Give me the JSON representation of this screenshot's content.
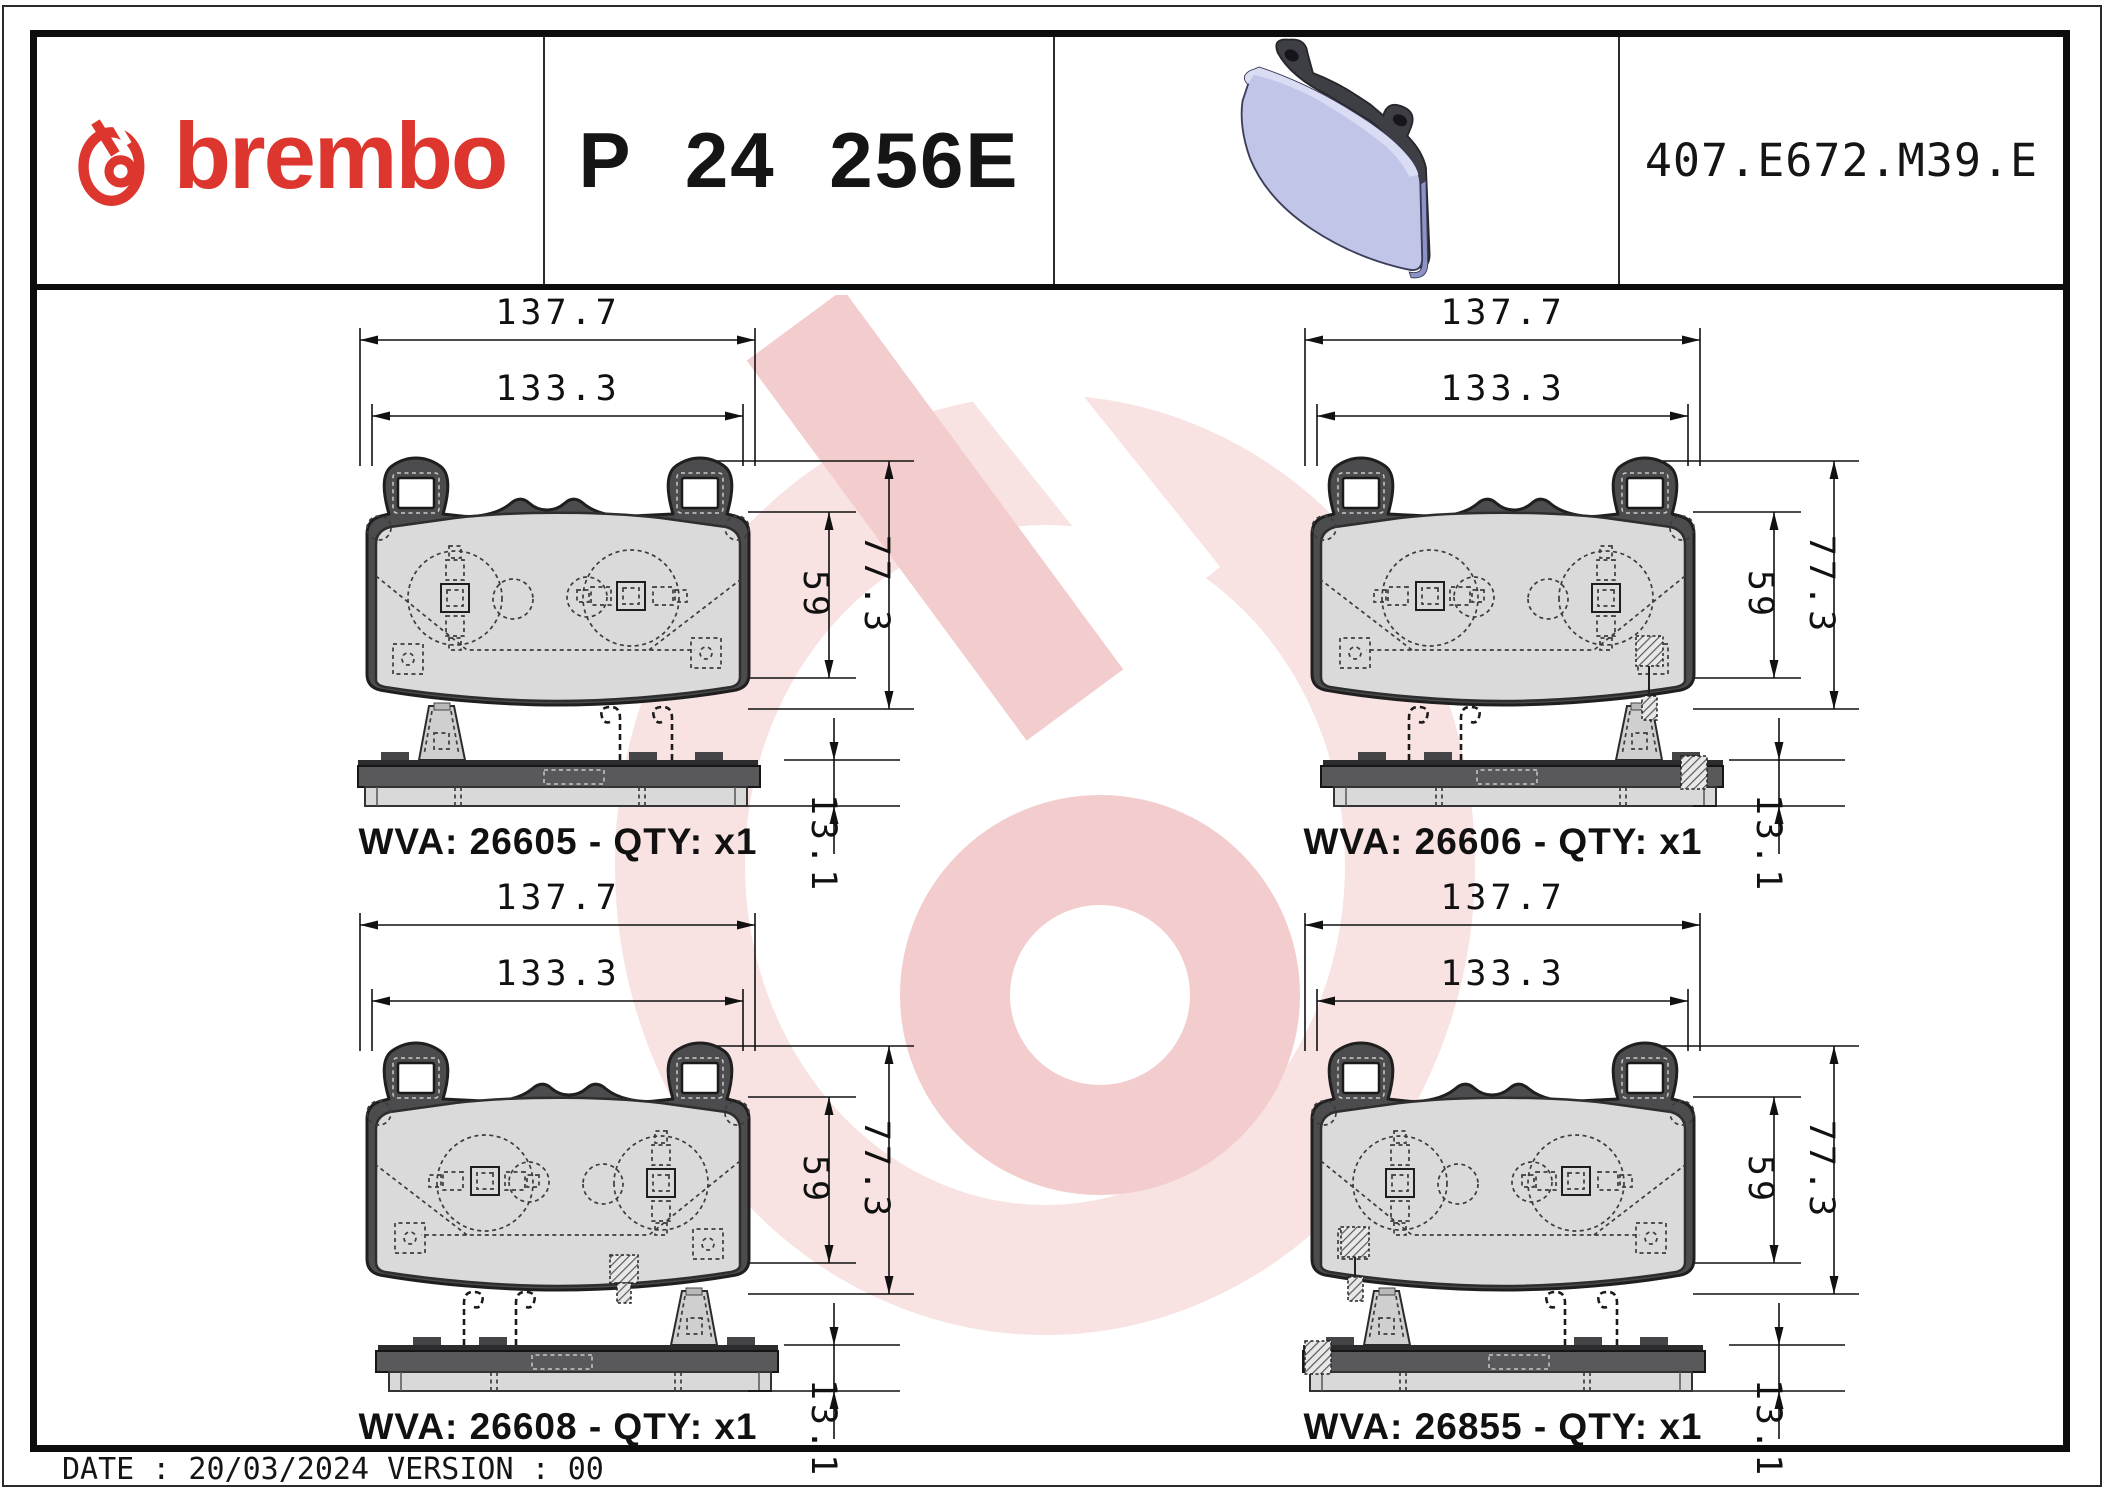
{
  "header": {
    "brand_text": "brembo",
    "part_number": "P 24 256E",
    "catalog_code": "407.E672.M39.E"
  },
  "dims": {
    "width_outer": "137.7",
    "width_inner": "133.3",
    "height_pad": "59",
    "height_total": "77.3",
    "thickness": "13.1"
  },
  "drawings": [
    {
      "wva": "26605",
      "qty": "x1",
      "wva_label": "WVA: 26605 - QTY: x1",
      "front_mirrored": false,
      "sensor_front": "none",
      "sensor_side": "none"
    },
    {
      "wva": "26606",
      "qty": "x1",
      "wva_label": "WVA: 26606 - QTY: x1",
      "front_mirrored": true,
      "sensor_front": "right",
      "sensor_side": "right"
    },
    {
      "wva": "26608",
      "qty": "x1",
      "wva_label": "WVA: 26608 - QTY: x1",
      "front_mirrored": true,
      "sensor_front": "mid",
      "sensor_side": "none"
    },
    {
      "wva": "26855",
      "qty": "x1",
      "wva_label": "WVA: 26855 - QTY: x1",
      "front_mirrored": false,
      "sensor_front": "left",
      "sensor_side": "left"
    }
  ],
  "footer": {
    "text": "DATE : 20/03/2024 VERSION : 00"
  },
  "colors": {
    "brand_red": "#dc362e",
    "watermark_pink_light": "#f8e2e2",
    "watermark_pink_mid": "#f3cdcd",
    "pad_lavender": "#c1c5e8",
    "plate_dark": "#4c4c4e",
    "friction_gray": "#dadada"
  }
}
